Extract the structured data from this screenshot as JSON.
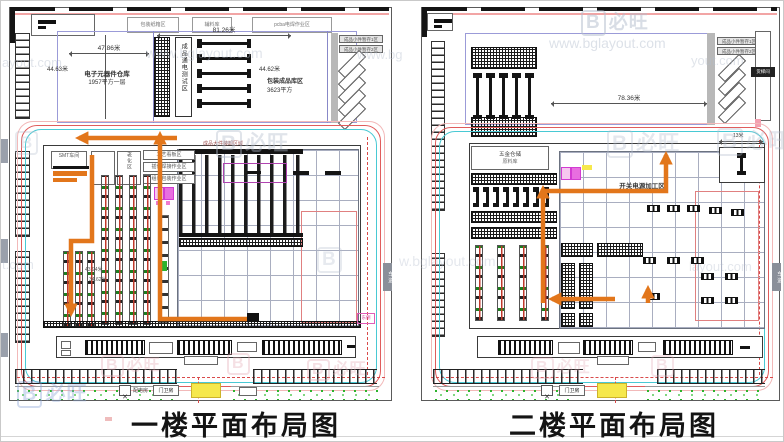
{
  "watermark": {
    "logo_letter": "B",
    "brand": "必旺",
    "url": "www.bglayout.com",
    "fragments": [
      "ayout.com",
      "yout.com",
      "t.com",
      "w.bglayout.com",
      "layout.com",
      "www.bg"
    ]
  },
  "captions": {
    "floor1": "一楼平面布局图",
    "floor2": "二楼平面布局图"
  },
  "floor1": {
    "top_labels": [
      "包装纸箱区",
      "辅料库",
      "pcba电焊作业区"
    ],
    "dims": {
      "top_width": "81.26米",
      "room1_width": "47.86米",
      "room1_height": "44.63米",
      "room2_height": "44.62米",
      "inner_a": "43.94米",
      "inner_b": "34.62米"
    },
    "rooms": {
      "warehouse_name": "电子元器件仓库",
      "warehouse_area": "1957平方一层",
      "test_area": "成品通电测试区",
      "finished_name": "包装成品库区",
      "finished_area": "3623平方"
    },
    "ramp_labels": [
      "成品小件暂存1区",
      "成品小件暂存2区"
    ],
    "workshop": {
      "box_a": "SMT车间",
      "box_b": "老化区",
      "stack": [
        "工艺看板区",
        "插件焊接作业区",
        "组装包装作业区"
      ],
      "dock_label": "成品大件装卸区域"
    },
    "gate": {
      "power_room": "配电房",
      "guard_room": "门卫房"
    },
    "edge": {
      "badge": "车道",
      "side_note": "东侧"
    }
  },
  "floor2": {
    "dims": {
      "hall_width": "78.36米",
      "right_small": "13米"
    },
    "rooms": {
      "metal_name": "五金仓储",
      "metal_area": "原料库",
      "process_area": "开关电源加工区"
    },
    "ramp_labels": [
      "成品小件暂存1区",
      "成品小件暂存2区"
    ],
    "lift_label": "货梯间",
    "gate": {
      "guard_room": "门卫房"
    },
    "edge": {
      "badge": "车道"
    }
  }
}
